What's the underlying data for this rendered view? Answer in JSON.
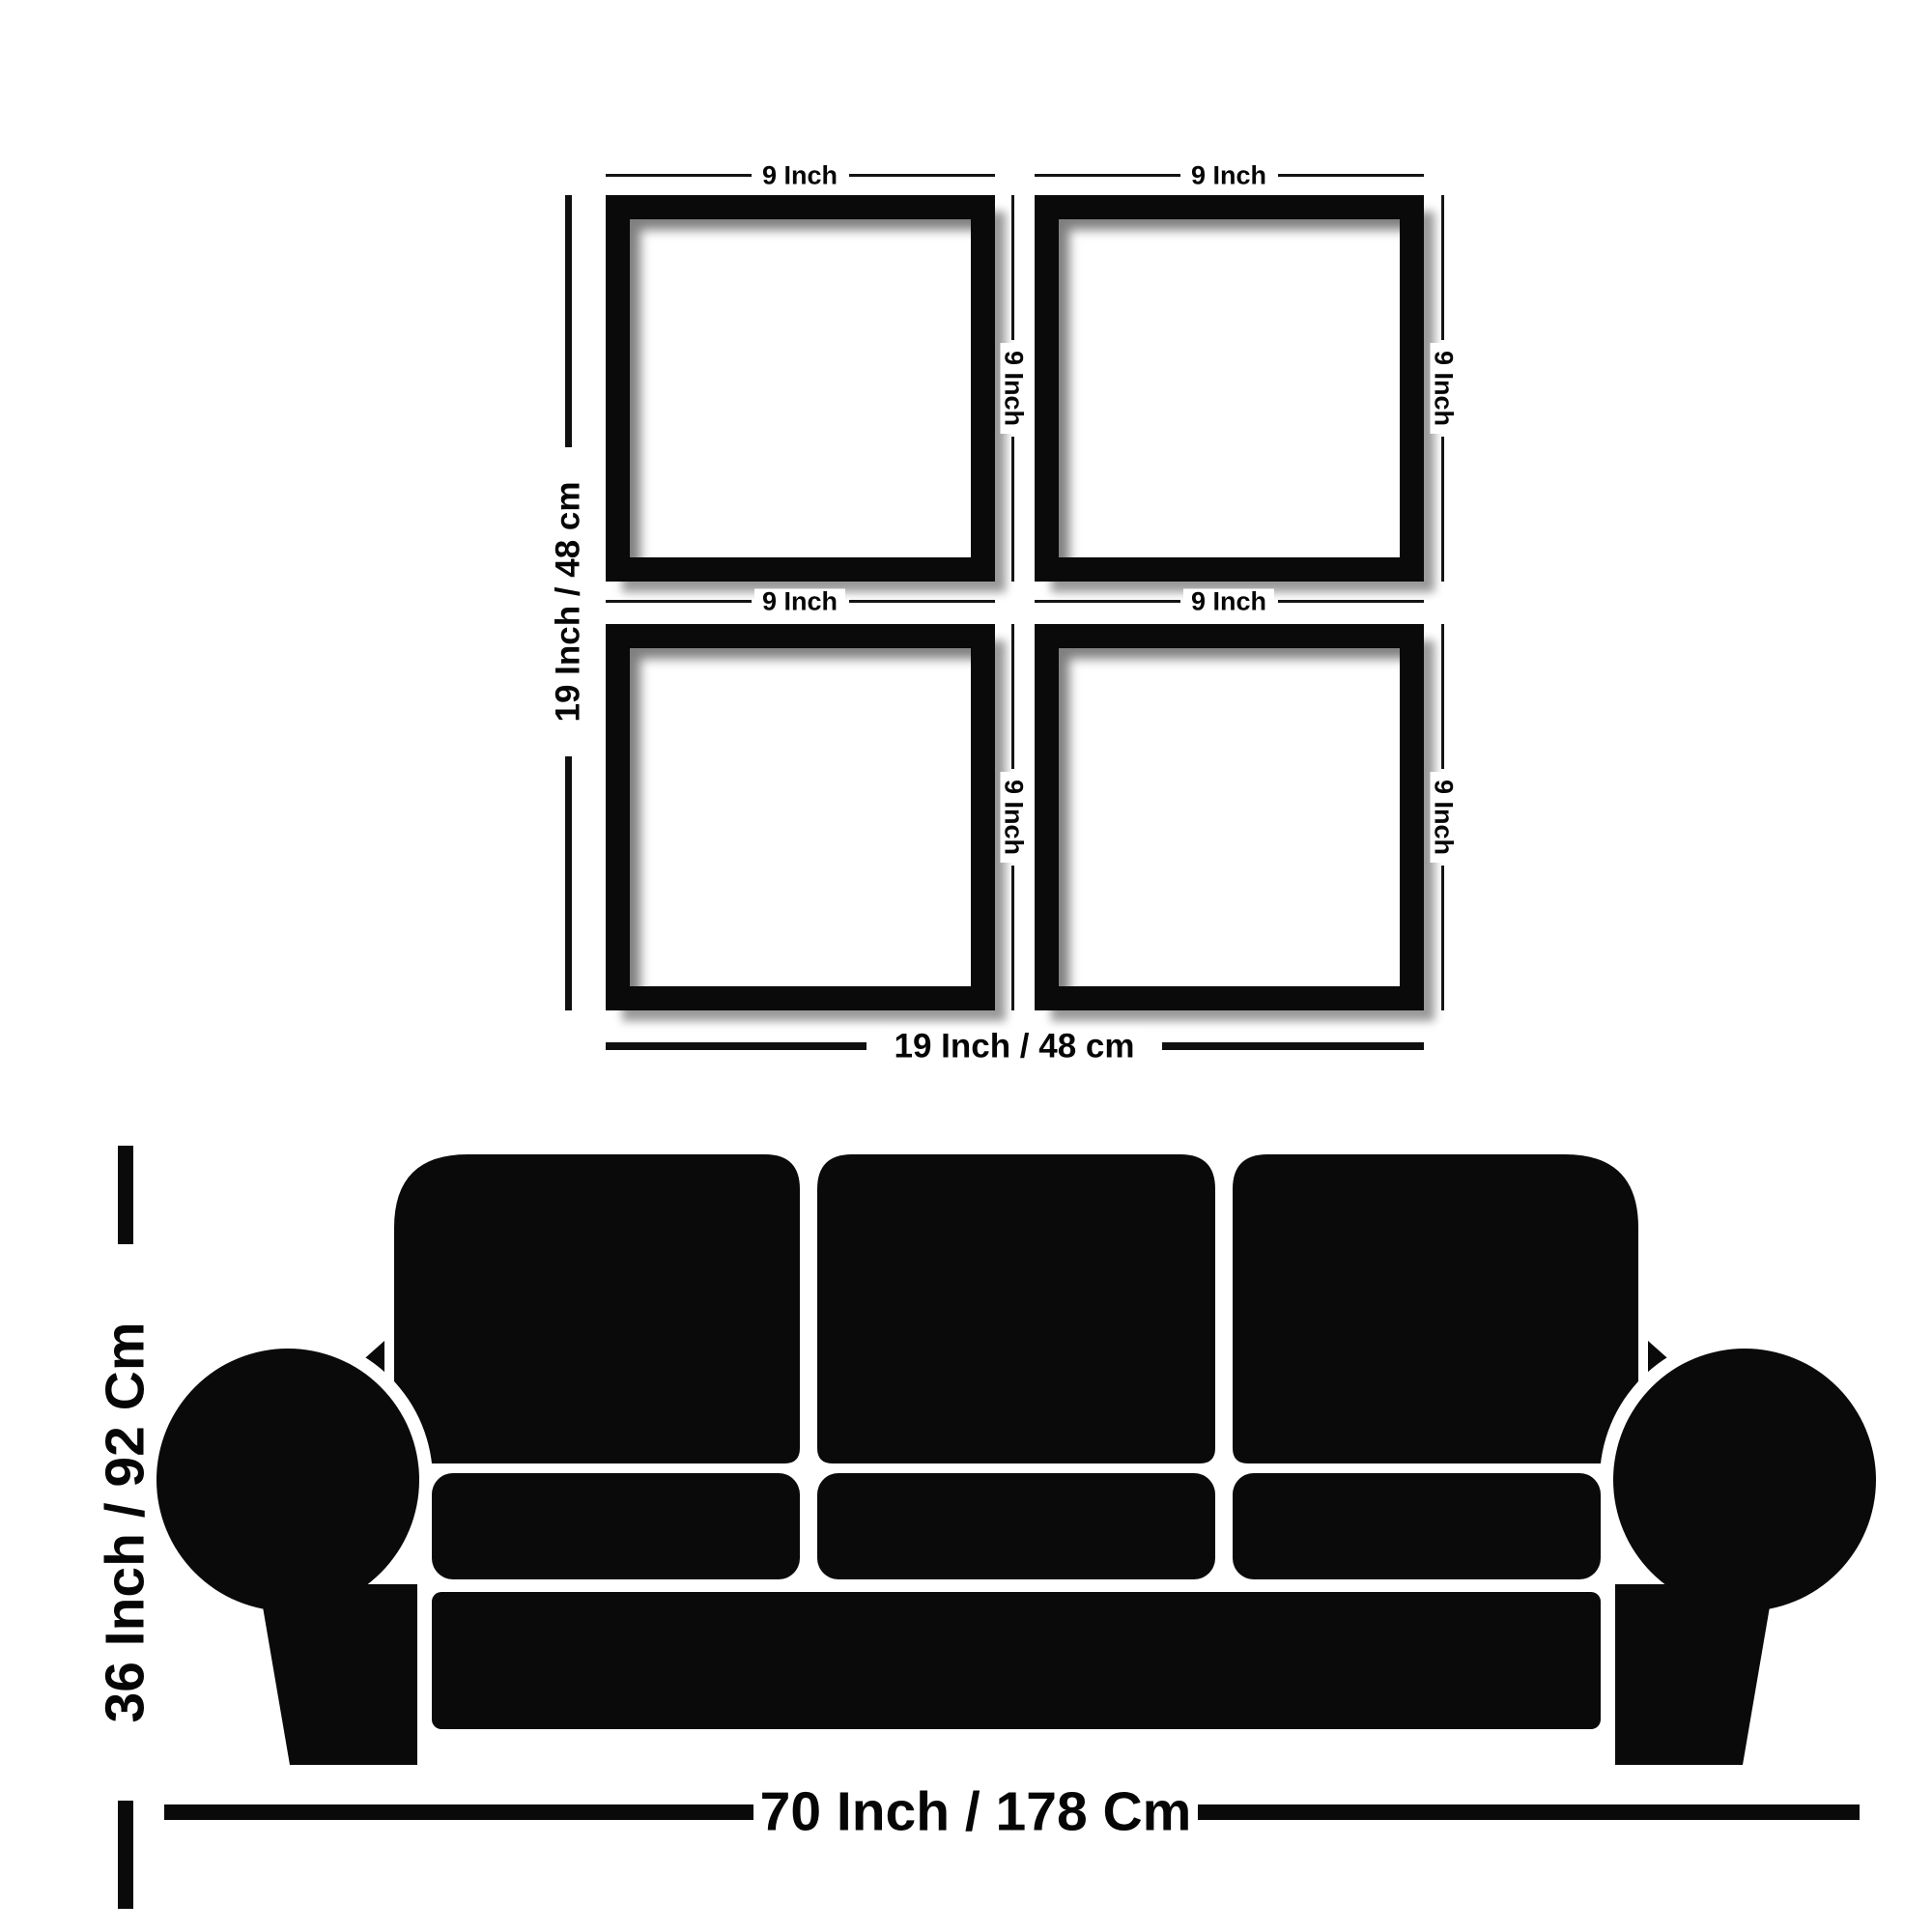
{
  "title": "Wall frame set and sofa size diagram",
  "colors": {
    "ink": "#0a0a0a",
    "background": "#ffffff",
    "text": "#060606"
  },
  "frame_grid": {
    "frames": [
      {
        "position": "top-left",
        "width_label": "9 Inch",
        "height_label": "9 Inch"
      },
      {
        "position": "top-right",
        "width_label": "9 Inch",
        "height_label": "9 Inch"
      },
      {
        "position": "bottom-left",
        "width_label": "9 Inch",
        "height_label": "9 Inch"
      },
      {
        "position": "bottom-right",
        "width_label": "9 Inch",
        "height_label": "9 Inch"
      }
    ],
    "overall_height_label": "19 Inch / 48 cm",
    "overall_width_label": "19 Inch / 48 cm"
  },
  "sofa": {
    "height_label": "36 Inch / 92 Cm",
    "width_label": "70 Inch / 178 Cm"
  }
}
